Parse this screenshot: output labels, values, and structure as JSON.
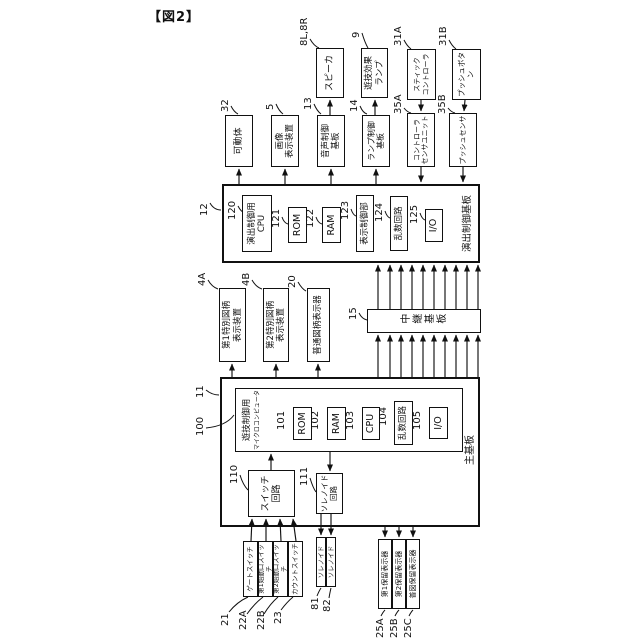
{
  "figure_label": "【図2】",
  "boards": {
    "effect_control": {
      "ref": "12",
      "label": "演出制御基板"
    },
    "main": {
      "ref": "11",
      "label": "主基板"
    },
    "relay": {
      "ref": "15",
      "label": "中継基板"
    }
  },
  "effect_board_components": {
    "cpu": {
      "ref": "120",
      "label": "演出制御用\nCPU"
    },
    "rom": {
      "ref": "121",
      "label": "ROM"
    },
    "ram": {
      "ref": "122",
      "label": "RAM"
    },
    "display_control": {
      "ref": "123",
      "label": "表示制御部"
    },
    "random_circuit": {
      "ref": "124",
      "label": "乱数回路"
    },
    "io": {
      "ref": "125",
      "label": "I/O"
    }
  },
  "main_board_components": {
    "microcomputer": {
      "ref": "100",
      "line1": "遊技制御用",
      "line2": "マイクロコンピュータ"
    },
    "rom": {
      "ref": "101",
      "label": "ROM"
    },
    "ram": {
      "ref": "102",
      "label": "RAM"
    },
    "cpu": {
      "ref": "103",
      "label": "CPU"
    },
    "random_circuit": {
      "ref": "104",
      "label": "乱数回路"
    },
    "io": {
      "ref": "105",
      "label": "I/O"
    },
    "switch_circuit": {
      "ref": "110",
      "label": "スイッチ\n回路"
    },
    "solenoid_circuit": {
      "ref": "111",
      "label": "ソレノイド\n回路"
    }
  },
  "peripherals": {
    "movable_body": {
      "ref": "32",
      "label": "可動体"
    },
    "image_display": {
      "ref": "5",
      "label": "画像\n表示装置"
    },
    "sound_control_board": {
      "ref": "13",
      "label": "音声制御\n基板"
    },
    "lamp_control_board": {
      "ref": "14",
      "label": "ランプ制御\n基板"
    },
    "speaker": {
      "ref": "8L,8R",
      "label": "スピーカ"
    },
    "effect_lamp": {
      "ref": "9",
      "label": "遊技効果\nランプ"
    },
    "stick_controller": {
      "ref": "31A",
      "label": "スティック\nコントローラ"
    },
    "controller_sensor_unit": {
      "ref": "35A",
      "label": "コントローラ\nセンサユニット"
    },
    "push_button": {
      "ref": "31B",
      "label": "プッシュボタン"
    },
    "push_sensor": {
      "ref": "35B",
      "label": "プッシュセンサ"
    },
    "special_symbol_display_1": {
      "ref": "4A",
      "label": "第1特別図柄\n表示装置"
    },
    "special_symbol_display_2": {
      "ref": "4B",
      "label": "第2特別図柄\n表示装置"
    },
    "normal_symbol_display": {
      "ref": "20",
      "label": "普通図柄表示器"
    },
    "gate_switch": {
      "ref": "21",
      "label": "ゲートスイッチ"
    },
    "start_switch_1": {
      "ref": "22A",
      "label": "第1始動口スイッチ"
    },
    "start_switch_2": {
      "ref": "22B",
      "label": "第2始動口スイッチ"
    },
    "count_switch": {
      "ref": "23",
      "label": "カウントスイッチ"
    },
    "solenoid_1": {
      "ref": "81",
      "label": "ソレノイド"
    },
    "solenoid_2": {
      "ref": "82",
      "label": "ソレノイド"
    },
    "hold_display_1": {
      "ref": "25A",
      "label": "第1保留表示器"
    },
    "hold_display_2": {
      "ref": "25B",
      "label": "第2保留表示器"
    },
    "normal_hold_display": {
      "ref": "25C",
      "label": "普図保留表示器"
    }
  }
}
